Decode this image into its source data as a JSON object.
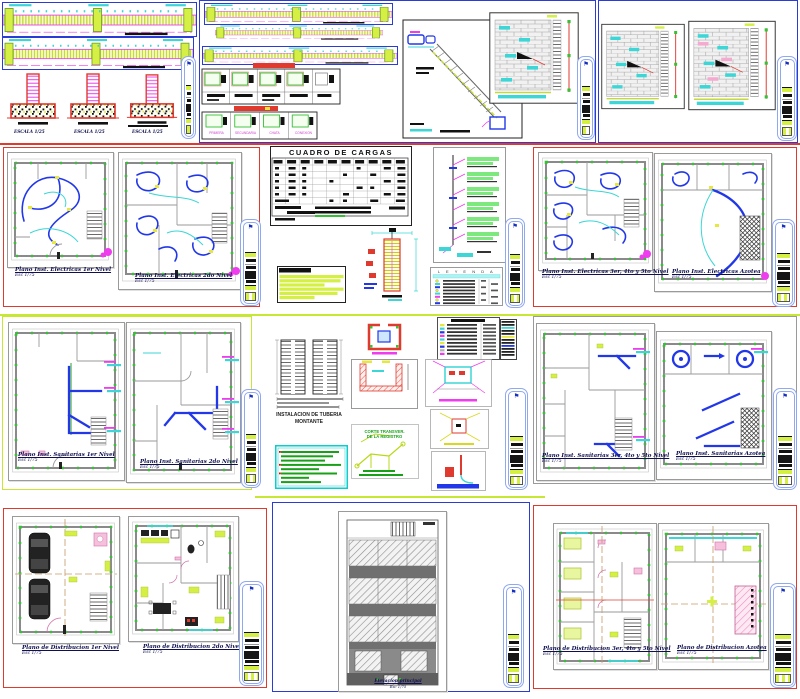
{
  "icons": {
    "north_arrow": "⚑"
  },
  "palette": {
    "accent_red": "#e0392e",
    "accent_blue": "#2b3bd6",
    "chartreuse": "#c6e832",
    "cyan": "#3cd6d6",
    "magenta": "#ee3cee",
    "marker_green": "#35c035",
    "pink": "#f5c0dc",
    "sheet_border": "#9a9a9a"
  },
  "structural": {
    "zapata_labels": [
      "ESCALA 1/25",
      "ESCALA 1/25",
      "ESCALA 1/25"
    ],
    "viga_labels": [
      "PRIMERA",
      "SECUNDARIA",
      "CHATA",
      "CONEXION"
    ]
  },
  "electrical": {
    "cuadro_cargas_title": "CUADRO DE CARGAS",
    "leyenda_title": "L E Y E N D A",
    "plans": [
      {
        "title": "Plano Inst. Electricas 1er Nivel",
        "scale": "Esc 1/75"
      },
      {
        "title": "Plano Inst. Electricas 2do Nivel",
        "scale": "Esc 1/75"
      },
      {
        "title": "Plano Inst. Electricas 3er, 4to y 5to Nivel",
        "scale": "Esc 1/75"
      },
      {
        "title": "Plano Inst. Electricas Azotea",
        "scale": "Esc 1/75"
      }
    ]
  },
  "sanitary": {
    "montante_caption_line1": "INSTALACION DE TUBERIA",
    "montante_caption_line2": "MONTANTE",
    "corte_caption_line1": "CORTE TRANSVER.",
    "corte_caption_line2": "DE LA REGISTRO",
    "plans": [
      {
        "title": "Plano Inst. Sanitarias 1er Nivel",
        "scale": "Esc 1/75"
      },
      {
        "title": "Plano Inst. Sanitarias 2do Nivel",
        "scale": "Esc 1/75"
      },
      {
        "title": "Plano Inst. Sanitarias 3er, 4to y 5to Nivel",
        "scale": "Esc 1/75"
      },
      {
        "title": "Plano Inst. Sanitarias Azotea",
        "scale": "Esc 1/75"
      }
    ]
  },
  "architecture": {
    "elevation": {
      "title": "Elevacion principal",
      "scale": "Esc 1/75"
    },
    "plans": [
      {
        "title": "Plano de Distribucion 1er Nivel",
        "scale": "Esc 1/75"
      },
      {
        "title": "Plano de Distribucion 2do Nivel",
        "scale": "Esc 1/75"
      },
      {
        "title": "Plano de Distribucion 3er, 4to y 5to Nivel",
        "scale": "Esc 1/75"
      },
      {
        "title": "Plano de Distribucion Azotea",
        "scale": "Esc 1/75"
      }
    ]
  }
}
